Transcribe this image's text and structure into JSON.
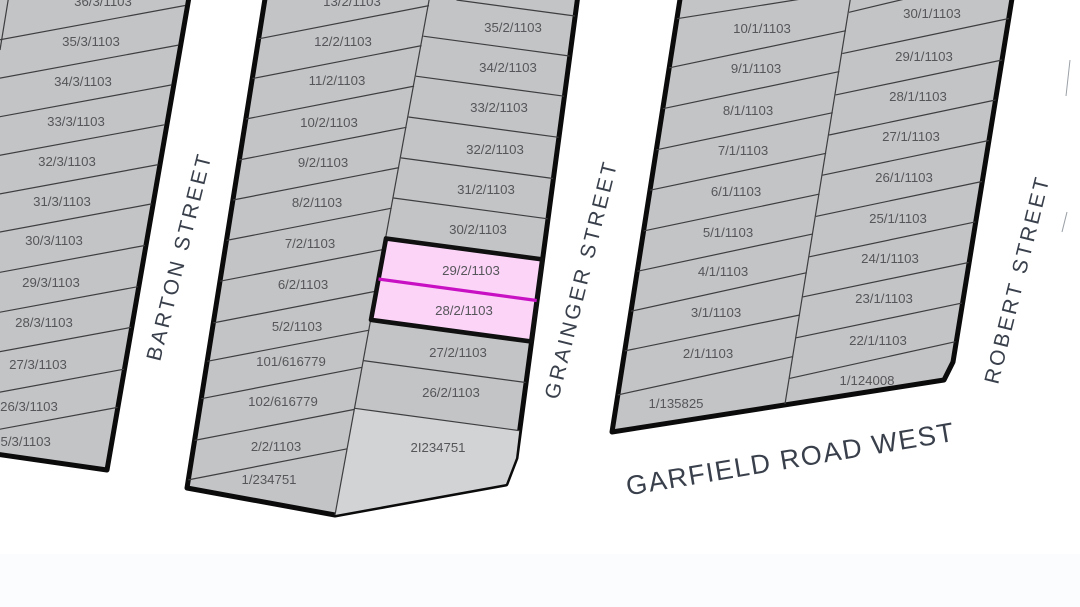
{
  "map": {
    "type": "cadastral-parcel-map",
    "streets": {
      "barton": "BARTON STREET",
      "grainger": "GRAINGER STREET",
      "robert": "ROBERT STREET",
      "garfield": "GARFIELD ROAD WEST"
    },
    "west_block": {
      "lots": [
        "36/3/1103",
        "35/3/1103",
        "34/3/1103",
        "33/3/1103",
        "32/3/1103",
        "31/3/1103",
        "30/3/1103",
        "29/3/1103",
        "28/3/1103",
        "27/3/1103",
        "26/3/1103",
        "25/3/1103"
      ]
    },
    "middle_block": {
      "west_lots": [
        "13/2/1103",
        "12/2/1103",
        "11/2/1103",
        "10/2/1103",
        "9/2/1103",
        "8/2/1103",
        "7/2/1103",
        "6/2/1103",
        "5/2/1103",
        "101/616779",
        "102/616779",
        "2/2/1103",
        "1/234751"
      ],
      "east_lots": [
        "35/2/1103",
        "34/2/1103",
        "33/2/1103",
        "32/2/1103",
        "31/2/1103",
        "30/2/1103",
        "29/2/1103",
        "28/2/1103",
        "27/2/1103",
        "26/2/1103",
        "2I234751"
      ]
    },
    "east_block": {
      "west_lots": [
        "10/1/1103",
        "9/1/1103",
        "8/1/1103",
        "7/1/1103",
        "6/1/1103",
        "5/1/1103",
        "4/1/1103",
        "3/1/1103",
        "2/1/1103",
        "1/135825"
      ],
      "east_lots": [
        "30/1/1103",
        "29/1/1103",
        "28/1/1103",
        "27/1/1103",
        "26/1/1103",
        "25/1/1103",
        "24/1/1103",
        "23/1/1103",
        "22/1/1103",
        "1/124008"
      ]
    },
    "highlight": {
      "lots": [
        "29/2/1103",
        "28/2/1103"
      ]
    },
    "colors": {
      "background": "#ffffff",
      "parcel_fill": "#c3c4c6",
      "parcel_fill_light": "#d2d3d5",
      "parcel_boundary": "#3e3e41",
      "block_outline": "#0b0b0b",
      "highlight_fill": "#fbd4f8",
      "highlight_divider": "#c911c4",
      "parcel_text": "#56565a",
      "street_text": "#39404b"
    }
  }
}
